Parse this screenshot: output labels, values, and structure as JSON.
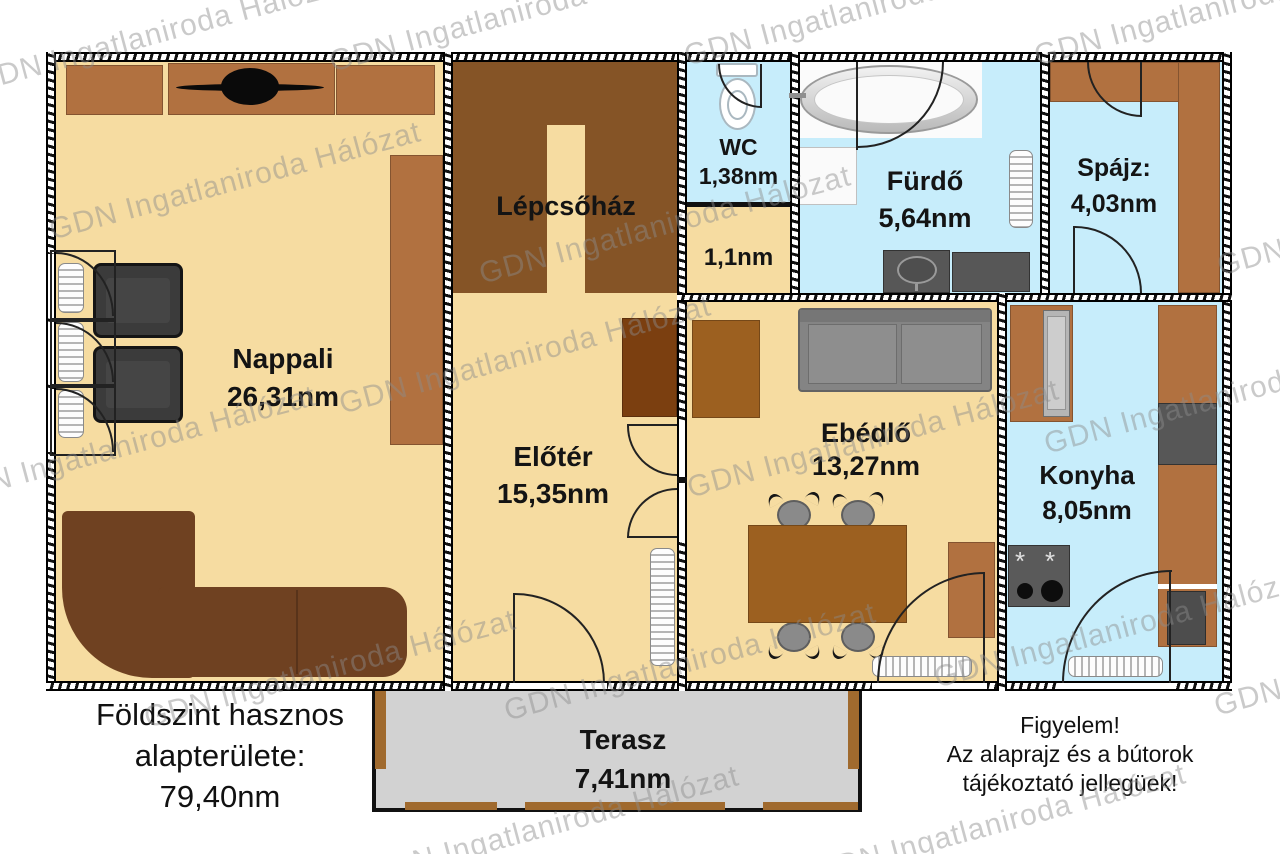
{
  "watermark": {
    "text": "GDN Ingatlaniroda Hálózat"
  },
  "rooms": [
    {
      "id": "nappali",
      "name": "Nappali",
      "area": "26,31nm"
    },
    {
      "id": "lepcsohaz",
      "name": "Lépcsőház",
      "area": ""
    },
    {
      "id": "eloter",
      "name": "Előtér",
      "area": "15,35nm"
    },
    {
      "id": "wc",
      "name": "WC",
      "area": "1,38nm"
    },
    {
      "id": "kamra",
      "name": "",
      "area": "1,1nm"
    },
    {
      "id": "furdo",
      "name": "Fürdő",
      "area": "5,64nm"
    },
    {
      "id": "spajz",
      "name": "Spájz:",
      "area": "4,03nm"
    },
    {
      "id": "ebedlo",
      "name": "Ebédlő",
      "area": "13,27nm"
    },
    {
      "id": "konyha",
      "name": "Konyha",
      "area": "8,05nm"
    },
    {
      "id": "terasz",
      "name": "Terasz",
      "area": "7,41nm"
    }
  ],
  "footer": {
    "area_note": {
      "line1": "Földszint hasznos",
      "line2": "alapterülete:",
      "line3": "79,40nm"
    },
    "disclaimer": {
      "line1": "Figyelem!",
      "line2": "Az alaprajz és a bútorok",
      "line3": "tájékoztató jellegüek!"
    }
  },
  "stove_burner_glyph": "*",
  "palette": {
    "floor_tan": "#F6DCA1",
    "floor_blue": "#C7EDFB",
    "stair_brown": "#855426",
    "furniture_brown": "#B17140",
    "furniture_dark_brown": "#7B3F10",
    "table_brown": "#9C6020",
    "sofa_brown": "#6F4121",
    "terrace_gray": "#D2D2D2",
    "post_brown": "#A06A2E",
    "appliance_gray": "#575757",
    "seat_gray": "#848484",
    "wall_black": "#111111",
    "watermark_gray": "#8C8C8C"
  }
}
